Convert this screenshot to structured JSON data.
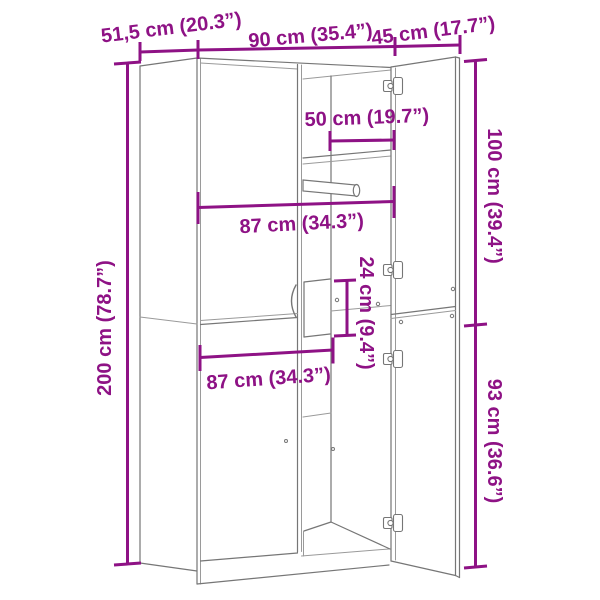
{
  "page": {
    "background": "#ffffff"
  },
  "diagram": {
    "title": "wardrobe-dimension-drawing",
    "accent_color": "#8e1285",
    "line_color": "#767676",
    "labels": {
      "depth": "51,5 cm (20.3”)",
      "width": "90 cm (35.4”)",
      "door_width": "45 cm (17.7”)",
      "rail_depth": "50 cm (19.7”)",
      "upper_section_height": "100 cm (39.4”)",
      "interior_width_upper": "87 cm (34.3”)",
      "niche_height": "24 cm (9.4”)",
      "total_height": "200 cm (78.7”)",
      "interior_width_lower": "87 cm (34.3”)",
      "lower_section_height": "93 cm (36.6”)"
    }
  }
}
